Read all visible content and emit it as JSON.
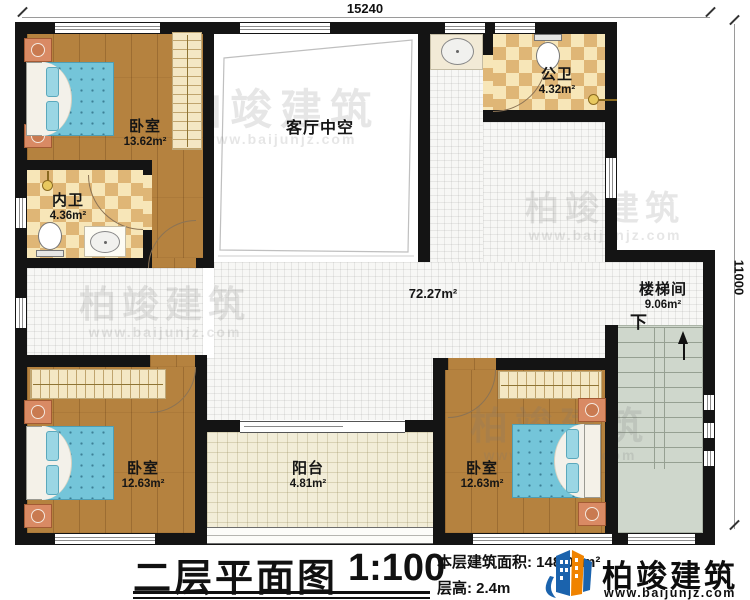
{
  "dimensions": {
    "top": "15240",
    "right": "11000"
  },
  "rooms": {
    "bedroom_top_left": {
      "name": "卧室",
      "area": "13.62m²"
    },
    "inner_bathroom": {
      "name": "内卫",
      "area": "4.36m²"
    },
    "living_room_void": {
      "name": "客厅中空"
    },
    "public_bathroom": {
      "name": "公卫",
      "area": "4.32m²"
    },
    "hallway": {
      "area": "72.27m²"
    },
    "stairwell": {
      "name": "楼梯间",
      "area": "9.06m²",
      "direction": "下"
    },
    "bedroom_bottom_left": {
      "name": "卧室",
      "area": "12.63m²"
    },
    "balcony": {
      "name": "阳台",
      "area": "4.81m²"
    },
    "bedroom_bottom_right": {
      "name": "卧室",
      "area": "12.63m²"
    }
  },
  "title_block": {
    "title": "二层平面图",
    "scale": "1:100",
    "floor_area": "本层建筑面积: 148.09m²",
    "floor_height": "层高: 2.4m"
  },
  "logo": {
    "name": "柏竣建筑",
    "website": "www.baijunjz.com"
  },
  "watermark": {
    "text": "柏竣建筑",
    "website": "www.baijunjz.com"
  },
  "colors": {
    "wall": "#141414",
    "wood_floor": "#b5823f",
    "bath_tile_dark": "#dfb676",
    "bath_tile_light": "#f7e6b8",
    "hall_tile": "#f7f7f5",
    "balcony_floor": "#f2edd8",
    "stair_floor": "#cfd7cc",
    "bed_mattress": "#74c5d9",
    "logo_blue": "#1b63ad",
    "logo_orange": "#f08300"
  }
}
